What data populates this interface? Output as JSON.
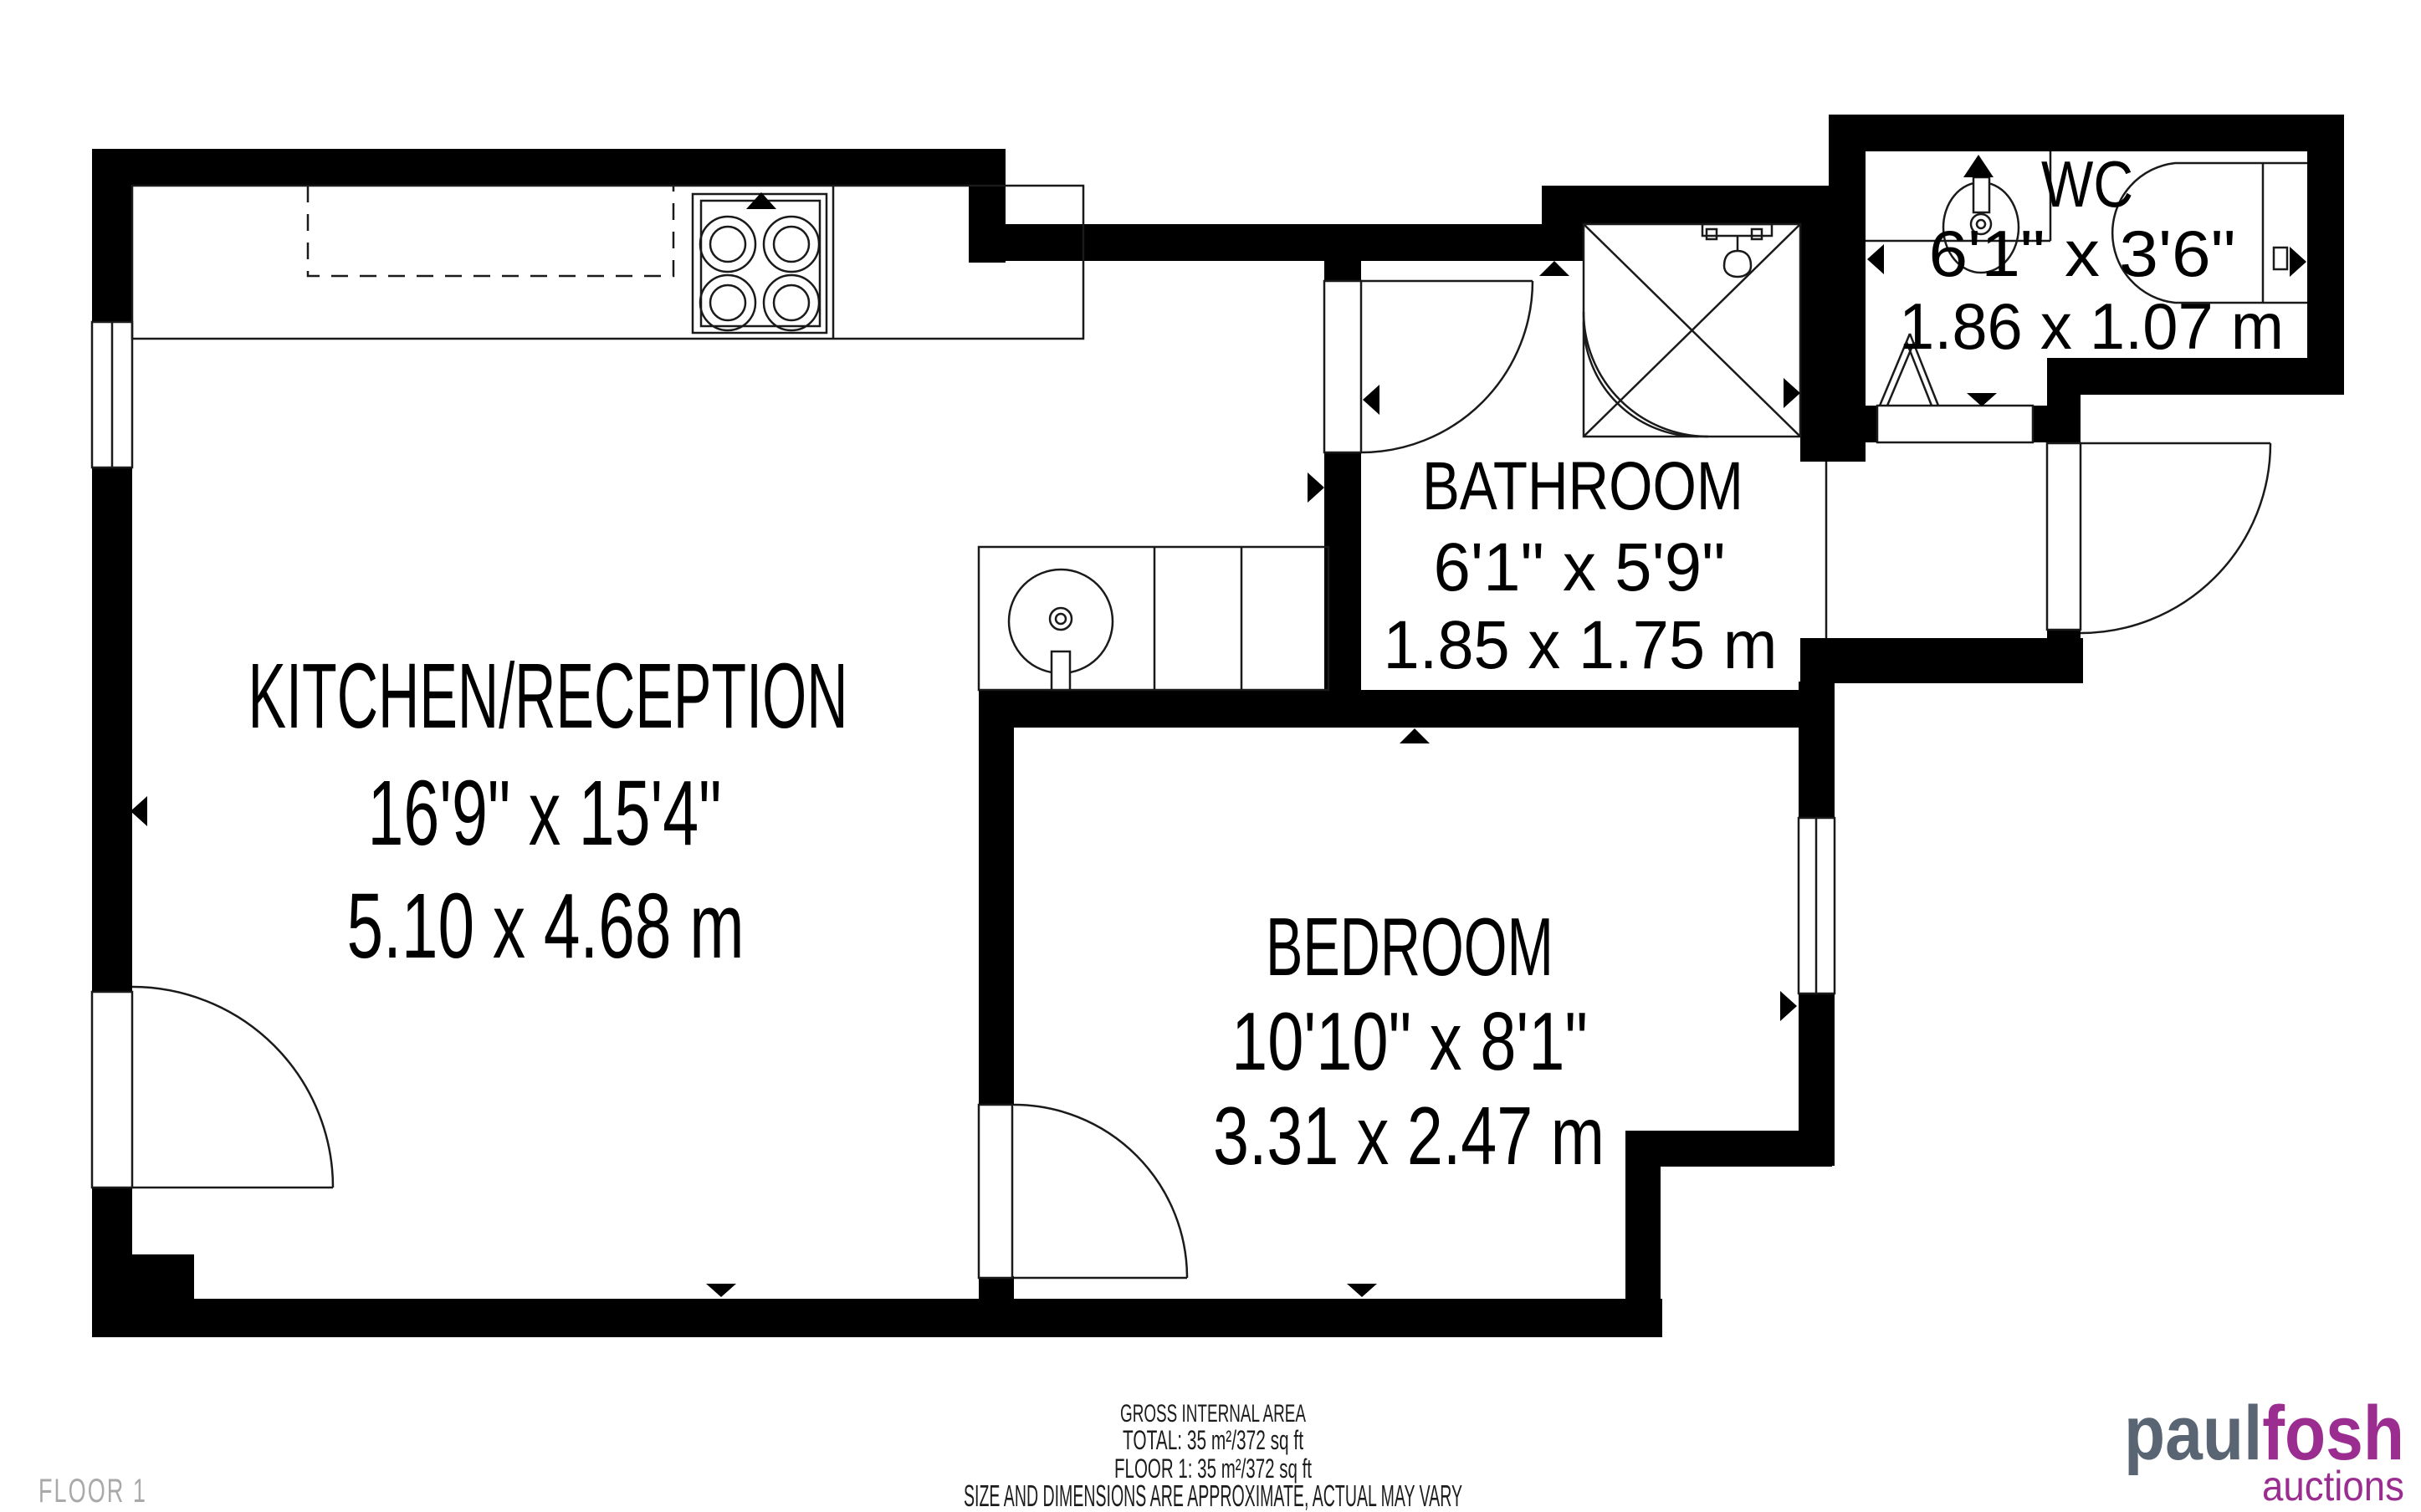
{
  "rooms": {
    "kitchen": {
      "name": "KITCHEN/RECEPTION",
      "imperial": "16'9\" x 15'4\"",
      "metric": "5.10 x 4.68 m"
    },
    "bathroom": {
      "name": "BATHROOM",
      "imperial": "6'1\" x 5'9\"",
      "metric": "1.85 x 1.75 m"
    },
    "wc": {
      "name": "WC",
      "imperial": "6'1\" x 3'6\"",
      "metric": "1.86 x 1.07 m"
    },
    "bedroom": {
      "name": "BEDROOM",
      "imperial": "10'10\" x 8'1\"",
      "metric": "3.31 x 2.47 m"
    }
  },
  "footer": {
    "gross_label": "GROSS INTERNAL AREA",
    "total": "TOTAL: 35 m²/372 sq ft",
    "floor1": "FLOOR 1: 35 m²/372 sq ft",
    "disclaimer": "SIZE AND DIMENSIONS ARE APPROXIMATE, ACTUAL MAY VARY"
  },
  "floor_label": "FLOOR 1",
  "logo": {
    "word1": "paul",
    "word2": "fosh",
    "word3": "auctions"
  },
  "colors": {
    "wall": "#000000",
    "line": "#1a1a1a",
    "muted_text": "#a7a7a7",
    "floor_label_text": "#a9a9a9",
    "logo_gray": "#5a6573",
    "logo_purple": "#9c2d90"
  }
}
